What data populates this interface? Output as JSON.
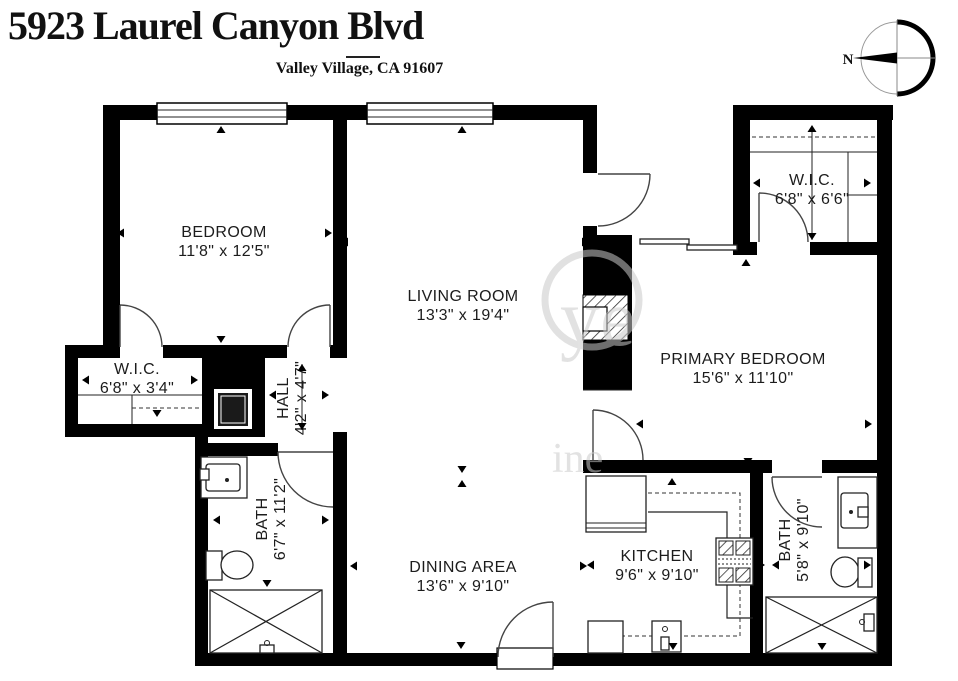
{
  "header": {
    "address": "5923 Laurel Canyon Blvd",
    "locality": "Valley Village, CA 91607"
  },
  "compass": {
    "north_label": "N"
  },
  "watermark": {
    "fragments": [
      "ye",
      "ine"
    ]
  },
  "rooms": [
    {
      "id": "bedroom",
      "name": "BEDROOM",
      "dims": "11'8\" x 12'5\"",
      "arrows": [
        [
          117,
          233,
          "l"
        ],
        [
          332,
          233,
          "r"
        ],
        [
          221,
          126,
          "u"
        ],
        [
          221,
          343,
          "d"
        ]
      ]
    },
    {
      "id": "living-room",
      "name": "LIVING ROOM",
      "dims": "13'3\" x 19'4\"",
      "arrows": [
        [
          341,
          242,
          "l"
        ],
        [
          589,
          242,
          "r"
        ],
        [
          462,
          126,
          "u"
        ],
        [
          462,
          473,
          "d"
        ]
      ]
    },
    {
      "id": "wic-primary",
      "name": "W.I.C.",
      "dims": "6'8\" x 6'6\"",
      "arrows": [
        [
          753,
          183,
          "l"
        ],
        [
          871,
          183,
          "r"
        ],
        [
          812,
          125,
          "u"
        ],
        [
          812,
          240,
          "d"
        ]
      ]
    },
    {
      "id": "primary-bedroom",
      "name": "PRIMARY BEDROOM",
      "dims": "15'6\" x 11'10\"",
      "arrows": [
        [
          636,
          424,
          "l"
        ],
        [
          872,
          424,
          "r"
        ],
        [
          746,
          259,
          "u"
        ],
        [
          748,
          465,
          "d"
        ]
      ]
    },
    {
      "id": "wic-hall",
      "name": "W.I.C.",
      "dims": "6'8\" x 3'4\"",
      "arrows": [
        [
          82,
          380,
          "l"
        ],
        [
          198,
          380,
          "r"
        ],
        [
          157,
          417,
          "d"
        ]
      ]
    },
    {
      "id": "hall",
      "name": "HALL",
      "dims": "4'2\" x 4'7\"",
      "arrows": [
        [
          269,
          395,
          "l"
        ],
        [
          329,
          395,
          "r"
        ],
        [
          302,
          364,
          "u"
        ],
        [
          302,
          430,
          "d"
        ]
      ]
    },
    {
      "id": "bath-hall",
      "name": "BATH",
      "dims": "6'7\" x 11'2\"",
      "arrows": [
        [
          213,
          520,
          "l"
        ],
        [
          329,
          520,
          "r"
        ],
        [
          267,
          587,
          "d"
        ]
      ]
    },
    {
      "id": "dining-area",
      "name": "DINING AREA",
      "dims": "13'6\" x 9'10\"",
      "arrows": [
        [
          350,
          566,
          "l"
        ],
        [
          587,
          566,
          "r"
        ],
        [
          462,
          480,
          "u"
        ],
        [
          461,
          649,
          "d"
        ]
      ]
    },
    {
      "id": "kitchen",
      "name": "KITCHEN",
      "dims": "9'6\" x 9'10\"",
      "arrows": [
        [
          587,
          565,
          "l"
        ],
        [
          765,
          565,
          "r"
        ],
        [
          672,
          478,
          "u"
        ],
        [
          673,
          650,
          "d"
        ]
      ]
    },
    {
      "id": "bath-primary",
      "name": "BATH",
      "dims": "5'8\" x 9'10\"",
      "arrows": [
        [
          772,
          565,
          "l"
        ],
        [
          871,
          565,
          "r"
        ],
        [
          822,
          650,
          "d"
        ]
      ]
    }
  ]
}
